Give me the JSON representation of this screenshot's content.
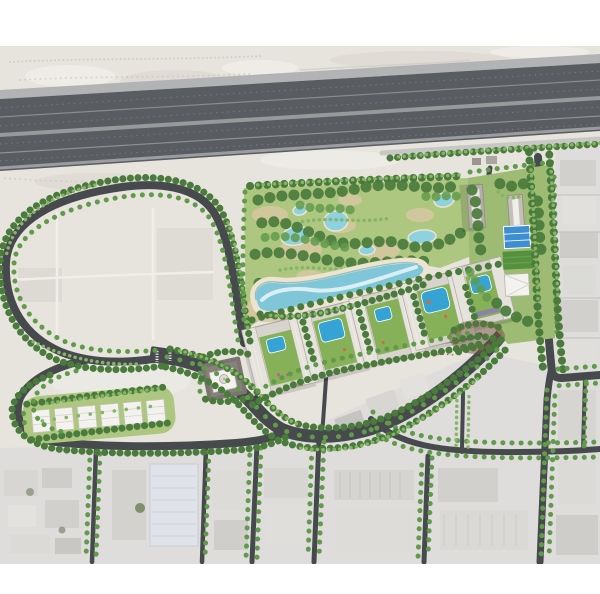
{
  "image": {
    "type": "architectural-masterplan-aerial-render",
    "description": "Aerial master-plan rendering of a landscaped residential development beside a multi-lane desert highway, surrounded by empty desert plots and an existing low-rise district to the south and east.",
    "width_px": 600,
    "height_px": 594
  },
  "palette": {
    "bg": "#ffffff",
    "sand": "#e7e3dd",
    "sand_light": "#efece7",
    "sand_dark": "#d8d3cb",
    "highway_asphalt": "#595c60",
    "highway_shoulder": "#b2b3b5",
    "road_dark": "#474a4d",
    "road_light": "#c7c7c5",
    "urban_base": "#dedddb",
    "urban_roof": "#d2d0cc",
    "urban_roof_dark": "#c6c4c0",
    "warehouse_roof": "#dfe3e9",
    "park_green": "#aec780",
    "lawn_green": "#55903f",
    "tree_dark": "#4a7b3c",
    "tree_mid": "#629a4b",
    "tree_light": "#85b565",
    "beach_sand": "#ece4cf",
    "dune_patch": "#d8c7a2",
    "lagoon_water": "#7fc6d8",
    "lagoon_highlight": "#e6f2f4",
    "pond_water": "#8ed1df",
    "pool_water": "#35a4d4",
    "court_blue": "#3e8ed2",
    "block_roof": "#d8d4cd",
    "block_wing": "#e6e3dd",
    "white_building": "#f3f2ef",
    "plaza_gray": "#7a766f",
    "track_red": "#b0522f",
    "deck_orange": "#c9703d",
    "deck_purple": "#8f7bb5"
  },
  "features": {
    "highway": {
      "label": "Multi-lane highway corridor crossing the top of the plan",
      "carriageways": 3
    },
    "service_road": {
      "label": "Light service road along the south edge of the highway"
    },
    "access_road": {
      "label": "Tree-lined arterial road descending from the highway on the east side"
    },
    "loop_road": {
      "label": "Large landscaped loop road around empty desert plots on the west"
    },
    "boulevard": {
      "label": "Curving tree-lined internal boulevard with planted median"
    },
    "internal_road": {
      "label": "Internal access road below the residential blocks"
    },
    "roundabout": {
      "label": "Landscaped roundabout at the east development entry",
      "count": 1
    },
    "central_park": {
      "label": "Central park with tree clusters, dune patches and ponds",
      "ponds": 6
    },
    "lagoon": {
      "label": "Winding swimming lagoon with sandy beach edge"
    },
    "residential_blocks": {
      "label": "Row of courtyard residential blocks with private pools",
      "count": 5
    },
    "towers": {
      "label": "Pair of slab towers in the north-east quarter",
      "count": 2
    },
    "sports_court": {
      "label": "Blue sports court deck"
    },
    "lawn_field": {
      "label": "Dark green lawn field"
    },
    "clubhouse": {
      "label": "White pitched-roof clubhouse building"
    },
    "mosque": {
      "label": "Small domed mosque on a gray plaza within a tree grove"
    },
    "grove_track": {
      "label": "Tree grove with red jogging track loop near the roundabout"
    },
    "villas_row": {
      "label": "Row of low villa buildings in a green band, south-west corner",
      "count": 6
    },
    "jogging_track": {
      "label": "Red jogging track threading the boulevard landscape"
    },
    "desert_plots": {
      "label": "Empty desert land with faint plot lines inside the loop road"
    },
    "urban_district": {
      "label": "Existing low-rise industrial district with tree-lined streets, south and east"
    },
    "warehouse": {
      "label": "Large pale-roofed warehouse in the south-west district"
    }
  }
}
